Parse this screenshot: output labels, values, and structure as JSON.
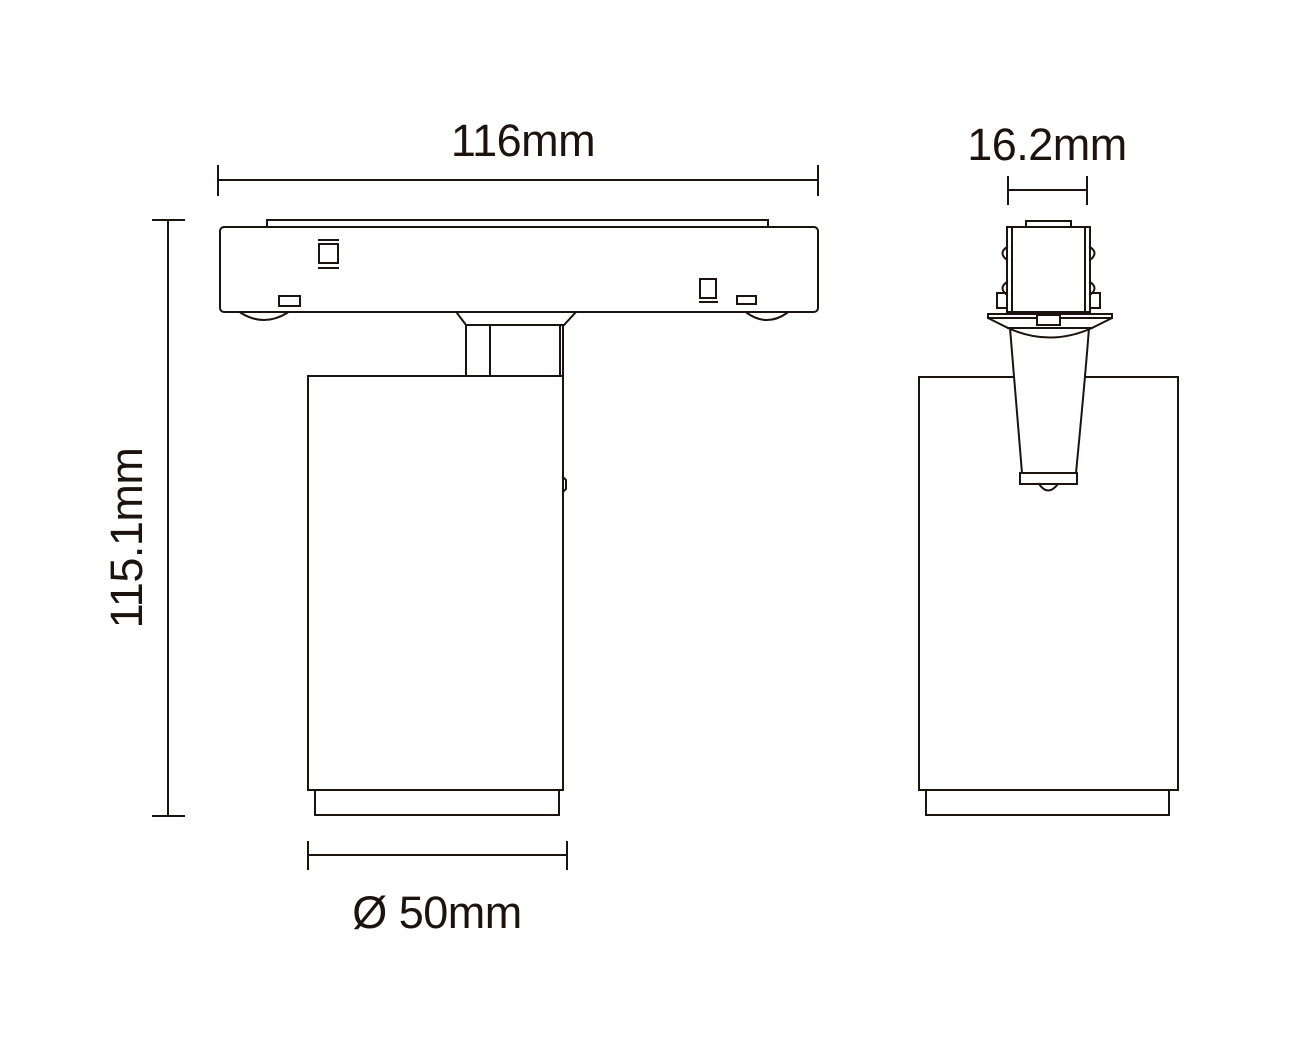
{
  "drawing": {
    "dimensions": {
      "width_label": "116mm",
      "depth_label": "16.2mm",
      "height_label": "115.1mm",
      "diameter_label": "Ø 50mm"
    },
    "colors": {
      "line": "#1d130e",
      "background": "#ffffff"
    }
  }
}
